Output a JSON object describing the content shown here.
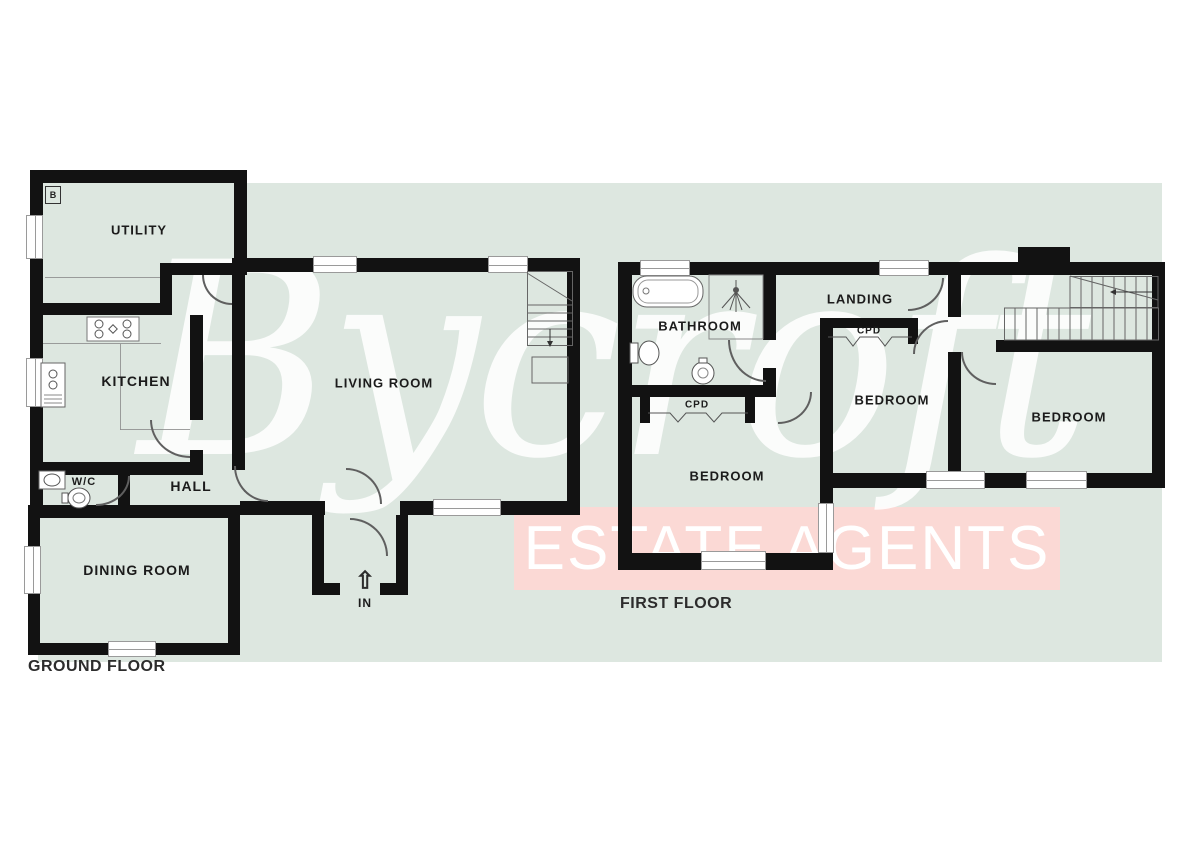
{
  "watermark": {
    "brand": "Bycroft",
    "tagline": "ESTATE AGENTS",
    "band_color": "#fbd9d5",
    "band_rect": [
      514,
      507,
      546,
      83
    ]
  },
  "plan": {
    "background_color": "#dde7e0",
    "backdrop_rect": [
      38,
      183,
      1124,
      479
    ],
    "wall_color": "#121212",
    "boiler_label": "B",
    "floors": [
      {
        "name": "GROUND FLOOR"
      },
      {
        "name": "FIRST FLOOR"
      }
    ],
    "rooms": [
      {
        "t": "UTILITY",
        "x": 139,
        "y": 230,
        "s": 13
      },
      {
        "t": "KITCHEN",
        "x": 136,
        "y": 381,
        "s": 14
      },
      {
        "t": "W/C",
        "x": 84,
        "y": 482,
        "s": 11
      },
      {
        "t": "HALL",
        "x": 191,
        "y": 486,
        "s": 14
      },
      {
        "t": "DINING ROOM",
        "x": 137,
        "y": 570,
        "s": 14
      },
      {
        "t": "LIVING ROOM",
        "x": 384,
        "y": 383,
        "s": 13
      },
      {
        "t": "IN",
        "x": 365,
        "y": 603,
        "s": 12
      },
      {
        "t": "BATHROOM",
        "x": 700,
        "y": 326,
        "s": 13
      },
      {
        "t": "LANDING",
        "x": 860,
        "y": 299,
        "s": 13
      },
      {
        "t": "CPD",
        "x": 697,
        "y": 405,
        "s": 10
      },
      {
        "t": "CPD",
        "x": 869,
        "y": 331,
        "s": 10
      },
      {
        "t": "BEDROOM",
        "x": 727,
        "y": 476,
        "s": 13
      },
      {
        "t": "BEDROOM",
        "x": 892,
        "y": 400,
        "s": 13
      },
      {
        "t": "BEDROOM",
        "x": 1069,
        "y": 417,
        "s": 13
      }
    ],
    "walls": [
      [
        30,
        170,
        217,
        13
      ],
      [
        30,
        170,
        13,
        145
      ],
      [
        30,
        315,
        13,
        160
      ],
      [
        30,
        475,
        13,
        43
      ],
      [
        234,
        170,
        13,
        95
      ],
      [
        160,
        263,
        87,
        12
      ],
      [
        160,
        263,
        12,
        52
      ],
      [
        30,
        303,
        142,
        12
      ],
      [
        190,
        315,
        13,
        105
      ],
      [
        190,
        450,
        13,
        25
      ],
      [
        30,
        462,
        160,
        13
      ],
      [
        118,
        475,
        12,
        43
      ],
      [
        28,
        505,
        212,
        13
      ],
      [
        28,
        505,
        12,
        150
      ],
      [
        28,
        643,
        212,
        12
      ],
      [
        228,
        505,
        12,
        150
      ],
      [
        232,
        258,
        13,
        212
      ],
      [
        232,
        258,
        348,
        14
      ],
      [
        567,
        258,
        13,
        257
      ],
      [
        400,
        501,
        180,
        14
      ],
      [
        240,
        501,
        85,
        14
      ],
      [
        312,
        515,
        12,
        80
      ],
      [
        396,
        515,
        12,
        80
      ],
      [
        312,
        583,
        28,
        12
      ],
      [
        380,
        583,
        28,
        12
      ],
      [
        618,
        262,
        26,
        13
      ],
      [
        690,
        262,
        191,
        13
      ],
      [
        929,
        262,
        233,
        13
      ],
      [
        1018,
        247,
        52,
        16
      ],
      [
        618,
        262,
        14,
        308
      ],
      [
        1152,
        262,
        13,
        226
      ],
      [
        618,
        385,
        158,
        12
      ],
      [
        763,
        275,
        13,
        65
      ],
      [
        763,
        368,
        13,
        20
      ],
      [
        820,
        318,
        13,
        252
      ],
      [
        820,
        318,
        98,
        10
      ],
      [
        908,
        318,
        10,
        26
      ],
      [
        948,
        262,
        13,
        55
      ],
      [
        948,
        352,
        13,
        123
      ],
      [
        996,
        340,
        166,
        12
      ],
      [
        820,
        473,
        342,
        15
      ],
      [
        618,
        553,
        215,
        17
      ],
      [
        640,
        397,
        10,
        26
      ],
      [
        745,
        397,
        10,
        26
      ]
    ],
    "windows": [
      {
        "r": [
          26,
          215,
          17,
          44
        ],
        "o": "v"
      },
      {
        "r": [
          26,
          358,
          17,
          49
        ],
        "o": "v"
      },
      {
        "r": [
          24,
          546,
          17,
          48
        ],
        "o": "v"
      },
      {
        "r": [
          108,
          641,
          48,
          16
        ],
        "o": "h"
      },
      {
        "r": [
          313,
          256,
          44,
          17
        ],
        "o": "h"
      },
      {
        "r": [
          488,
          256,
          40,
          17
        ],
        "o": "h"
      },
      {
        "r": [
          433,
          499,
          68,
          17
        ],
        "o": "h"
      },
      {
        "r": [
          640,
          260,
          50,
          16
        ],
        "o": "h"
      },
      {
        "r": [
          879,
          260,
          50,
          16
        ],
        "o": "h"
      },
      {
        "r": [
          926,
          471,
          59,
          18
        ],
        "o": "h"
      },
      {
        "r": [
          1026,
          471,
          61,
          18
        ],
        "o": "h"
      },
      {
        "r": [
          701,
          551,
          65,
          19
        ],
        "o": "h"
      },
      {
        "r": [
          818,
          503,
          16,
          50
        ],
        "o": "v"
      }
    ],
    "doors": [
      {
        "r": [
          202,
          275,
          30,
          30
        ],
        "c": "bl"
      },
      {
        "r": [
          150,
          420,
          40,
          38
        ],
        "c": "bl"
      },
      {
        "r": [
          234,
          466,
          34,
          36
        ],
        "c": "bl"
      },
      {
        "r": [
          346,
          468,
          36,
          36
        ],
        "c": "tr"
      },
      {
        "r": [
          350,
          518,
          38,
          38
        ],
        "c": "tr"
      },
      {
        "r": [
          96,
          476,
          34,
          30
        ],
        "c": "br"
      },
      {
        "r": [
          728,
          340,
          38,
          42
        ],
        "c": "bl"
      },
      {
        "r": [
          778,
          392,
          34,
          32
        ],
        "c": "br"
      },
      {
        "r": [
          913,
          320,
          35,
          34
        ],
        "c": "tl"
      },
      {
        "r": [
          961,
          352,
          35,
          33
        ],
        "c": "bl"
      },
      {
        "r": [
          908,
          278,
          36,
          33
        ],
        "c": "br"
      }
    ],
    "lines": [
      [
        45,
        277,
        115,
        1
      ],
      [
        43,
        343,
        118,
        1
      ],
      [
        120,
        344,
        1,
        86
      ],
      [
        120,
        429,
        70,
        1
      ]
    ]
  }
}
